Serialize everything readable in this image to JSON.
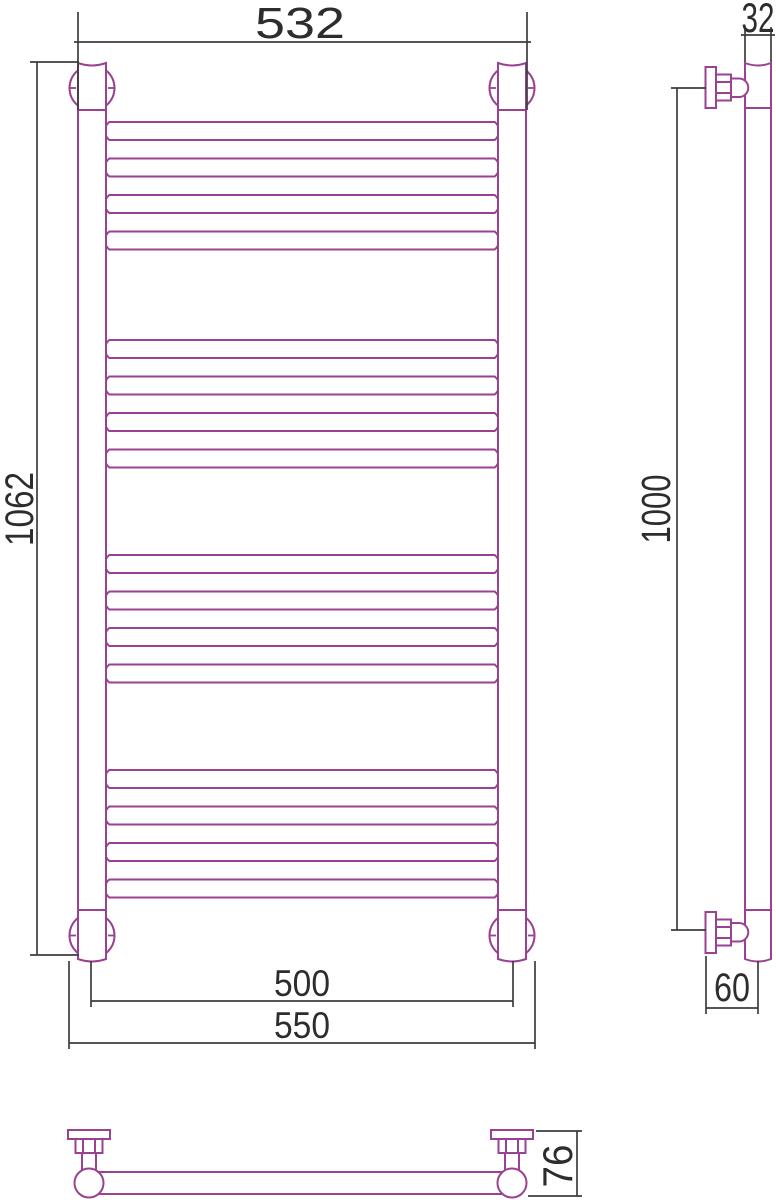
{
  "meta": {
    "drawing_type": "technical dimension drawing",
    "subject": "ladder heated towel rail (front view, side view, bottom view)"
  },
  "colors": {
    "outline": "#9a4191",
    "dimension_lines": "#3d3d3d",
    "text": "#2d2d2d",
    "background": "#ffffff"
  },
  "views": {
    "front": {
      "rung_count": 16,
      "rung_groups": 4,
      "dims": {
        "width_top": "532",
        "height": "1062",
        "width_axis": "500",
        "width_overall": "550"
      }
    },
    "side": {
      "dims": {
        "tube_diameter": "32",
        "mount_height": "1000",
        "wall_offset": "60"
      }
    },
    "bottom": {
      "dims": {
        "depth": "76"
      }
    }
  }
}
